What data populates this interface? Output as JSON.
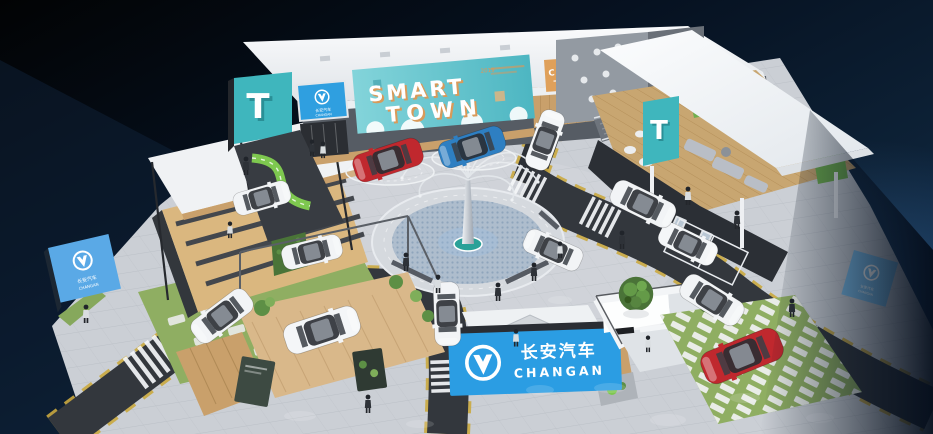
{
  "scene": {
    "banner": {
      "line1": "SMART",
      "line2": "TOWN",
      "caption": "2019"
    },
    "brand": {
      "cn": "长安汽车",
      "en": "CHANGAN"
    },
    "signs": {
      "club": "CHANG",
      "screen_left": "T",
      "screen_right": "T"
    },
    "colors": {
      "accent_blue": "#2b9de3",
      "sign_blue": "#2f9fe0",
      "billboard_blue": "#5aa9e6",
      "teal_screen": "#3fb6bd",
      "banner_teal": "#6fcdd2",
      "car_red": "#c0282e",
      "car_blue": "#2e7fc2",
      "road": "#33373d",
      "floor": "#cbcfd5",
      "wood": "#c9a06b",
      "grass": "#86a85c",
      "roof_white": "#f4f6f8",
      "lane_yellow": "#d9b93e",
      "club_orange": "#dfa05a"
    }
  }
}
